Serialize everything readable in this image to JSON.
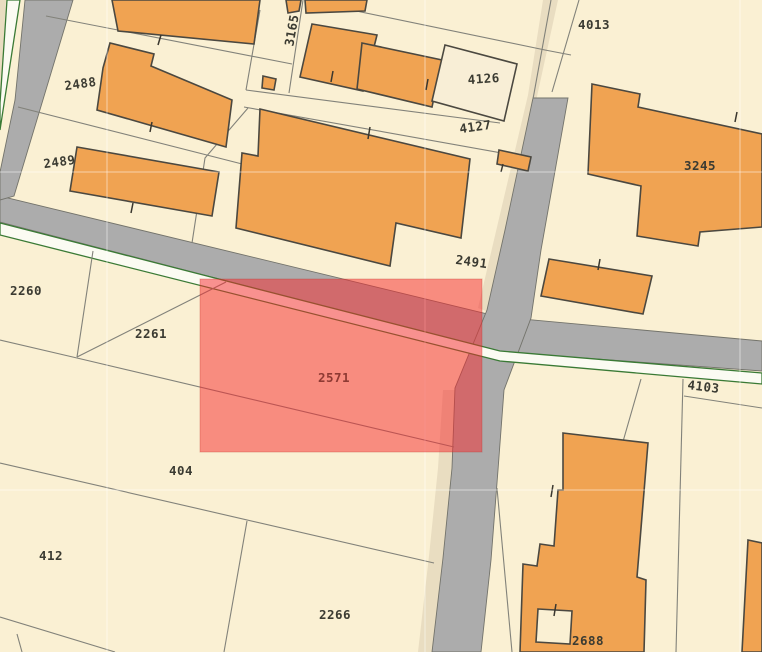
{
  "map": {
    "canvas": {
      "width": 762,
      "height": 652
    },
    "colors": {
      "parcel_base": "#FAF0D3",
      "parcel_dark": "#E9DDC1",
      "road": "#ACACAC",
      "road_edge": "#73736B",
      "stripe": "#FBFBF2",
      "stripe_green": "#3A7A35",
      "building": "#F0A352",
      "building_unfilled": "#F8EED6",
      "building_outline": "#4B4840",
      "parcel_line": "#82827A",
      "label": "#3B3B32",
      "tick": "#3A372F",
      "graticule": "rgba(255,255,255,0.5)",
      "selection_fill": "rgba(246,40,44,0.5)",
      "selection_stroke": "rgba(190,45,35,0.3)",
      "selection_label": "#8E3A33"
    },
    "accents": [
      {
        "name": "corner-verge-topleft",
        "points": [
          [
            0,
            0
          ],
          [
            6,
            0
          ],
          [
            0,
            100
          ]
        ]
      },
      {
        "name": "verge-band-topright",
        "points": [
          [
            543,
            0
          ],
          [
            558,
            0
          ],
          [
            508,
            230
          ],
          [
            489,
            312
          ],
          [
            478,
            308
          ],
          [
            528,
            95
          ]
        ]
      },
      {
        "name": "verge-band-bottom",
        "points": [
          [
            443,
            390
          ],
          [
            456,
            390
          ],
          [
            452,
            470
          ],
          [
            443,
            558
          ],
          [
            432,
            652
          ],
          [
            418,
            652
          ],
          [
            429,
            556
          ],
          [
            438,
            468
          ]
        ]
      }
    ],
    "roads": [
      {
        "name": "main-diagonal-road",
        "points": [
          [
            0,
            196
          ],
          [
            500,
            317
          ],
          [
            762,
            341
          ],
          [
            762,
            371
          ],
          [
            500,
            352
          ],
          [
            0,
            222
          ]
        ]
      },
      {
        "name": "left-edge-road",
        "points": [
          [
            25,
            0
          ],
          [
            73,
            0
          ],
          [
            14,
            196
          ],
          [
            0,
            200
          ],
          [
            0,
            172
          ],
          [
            15,
            100
          ]
        ]
      },
      {
        "name": "vertical-road",
        "points": [
          [
            533,
            98
          ],
          [
            568,
            98
          ],
          [
            541,
            250
          ],
          [
            531,
            318
          ],
          [
            504,
            390
          ],
          [
            498,
            470
          ],
          [
            491,
            560
          ],
          [
            481,
            652
          ],
          [
            432,
            652
          ],
          [
            443,
            558
          ],
          [
            452,
            468
          ],
          [
            455,
            388
          ],
          [
            487,
            310
          ],
          [
            505,
            230
          ]
        ]
      }
    ],
    "stripes": [
      {
        "name": "sidewalk-stripe-main",
        "points": [
          [
            0,
            223
          ],
          [
            500,
            351
          ],
          [
            762,
            373
          ],
          [
            762,
            384
          ],
          [
            500,
            361
          ],
          [
            0,
            235
          ]
        ]
      },
      {
        "name": "sidewalk-stripe-left",
        "points": [
          [
            7,
            0
          ],
          [
            20,
            0
          ],
          [
            0,
            130
          ],
          [
            0,
            103
          ]
        ]
      }
    ],
    "parcel_lines": [
      {
        "name": "a",
        "points": [
          [
            46,
            16
          ],
          [
            292,
            64
          ]
        ]
      },
      {
        "name": "b",
        "points": [
          [
            18,
            107
          ],
          [
            250,
            166
          ]
        ]
      },
      {
        "name": "c",
        "points": [
          [
            260,
            10
          ],
          [
            246,
            90
          ]
        ]
      },
      {
        "name": "d",
        "points": [
          [
            303,
            0
          ],
          [
            289,
            93
          ]
        ]
      },
      {
        "name": "e",
        "points": [
          [
            246,
            90
          ],
          [
            500,
            123
          ]
        ]
      },
      {
        "name": "f",
        "points": [
          [
            244,
            107
          ],
          [
            530,
            158
          ]
        ]
      },
      {
        "name": "g",
        "points": [
          [
            332,
            6
          ],
          [
            545,
            50
          ],
          [
            571,
            55
          ]
        ]
      },
      {
        "name": "g2",
        "points": [
          [
            248,
            108
          ],
          [
            205,
            158
          ],
          [
            192,
            243
          ]
        ]
      },
      {
        "name": "h",
        "points": [
          [
            551,
            0
          ],
          [
            533,
            99
          ]
        ]
      },
      {
        "name": "i",
        "points": [
          [
            579,
            0
          ],
          [
            552,
            92
          ]
        ]
      },
      {
        "name": "k",
        "points": [
          [
            93,
            251
          ],
          [
            77,
            357
          ]
        ]
      },
      {
        "name": "l",
        "points": [
          [
            0,
            340
          ],
          [
            77,
            358
          ],
          [
            454,
            447
          ]
        ]
      },
      {
        "name": "m",
        "points": [
          [
            226,
            282
          ],
          [
            77,
            357
          ]
        ]
      },
      {
        "name": "n",
        "points": [
          [
            0,
            463
          ],
          [
            434,
            563
          ]
        ]
      },
      {
        "name": "o1",
        "points": [
          [
            0,
            617
          ],
          [
            115,
            652
          ]
        ]
      },
      {
        "name": "o2",
        "points": [
          [
            17,
            634
          ],
          [
            22,
            652
          ]
        ]
      },
      {
        "name": "p",
        "points": [
          [
            247,
            521
          ],
          [
            224,
            652
          ]
        ]
      },
      {
        "name": "r",
        "points": [
          [
            683,
            379
          ],
          [
            676,
            652
          ]
        ]
      },
      {
        "name": "r0",
        "points": [
          [
            641,
            379
          ],
          [
            622,
            445
          ]
        ]
      },
      {
        "name": "r2",
        "points": [
          [
            684,
            396
          ],
          [
            762,
            408
          ]
        ]
      },
      {
        "name": "t",
        "points": [
          [
            497,
            488
          ],
          [
            512,
            652
          ]
        ]
      }
    ],
    "buildings": [
      {
        "name": "top-strip-a",
        "fill": "building",
        "points": [
          [
            112,
            0
          ],
          [
            260,
            0
          ],
          [
            254,
            44
          ],
          [
            118,
            31
          ]
        ]
      },
      {
        "name": "top-strip-b",
        "fill": "building",
        "points": [
          [
            286,
            0
          ],
          [
            301,
            0
          ],
          [
            299,
            11
          ],
          [
            288,
            13
          ]
        ]
      },
      {
        "name": "top-strip-c",
        "fill": "building",
        "points": [
          [
            305,
            0
          ],
          [
            367,
            0
          ],
          [
            365,
            11
          ],
          [
            306,
            13
          ]
        ]
      },
      {
        "name": "building-2488",
        "fill": "building",
        "points": [
          [
            103,
            68
          ],
          [
            110,
            43
          ],
          [
            154,
            54
          ],
          [
            151,
            66
          ],
          [
            232,
            100
          ],
          [
            226,
            147
          ],
          [
            97,
            110
          ]
        ]
      },
      {
        "name": "building-2489",
        "fill": "building",
        "points": [
          [
            77,
            147
          ],
          [
            219,
            172
          ],
          [
            212,
            216
          ],
          [
            70,
            191
          ]
        ]
      },
      {
        "name": "small-square",
        "fill": "building",
        "points": [
          [
            263,
            76
          ],
          [
            276,
            79
          ],
          [
            274,
            90
          ],
          [
            262,
            88
          ]
        ]
      },
      {
        "name": "pair-left",
        "fill": "building",
        "points": [
          [
            312,
            24
          ],
          [
            377,
            35
          ],
          [
            363,
            91
          ],
          [
            300,
            77
          ]
        ]
      },
      {
        "name": "pair-right",
        "fill": "building",
        "points": [
          [
            362,
            43
          ],
          [
            442,
            60
          ],
          [
            432,
            107
          ],
          [
            357,
            89
          ]
        ]
      },
      {
        "name": "building-4126",
        "fill": "building_unfilled",
        "points": [
          [
            445,
            45
          ],
          [
            517,
            64
          ],
          [
            504,
            121
          ],
          [
            432,
            101
          ]
        ]
      },
      {
        "name": "small-4127",
        "fill": "building",
        "points": [
          [
            499,
            150
          ],
          [
            531,
            157
          ],
          [
            528,
            171
          ],
          [
            497,
            164
          ]
        ]
      },
      {
        "name": "central-building",
        "fill": "building",
        "points": [
          [
            260,
            109
          ],
          [
            470,
            159
          ],
          [
            461,
            238
          ],
          [
            396,
            223
          ],
          [
            390,
            266
          ],
          [
            236,
            228
          ],
          [
            242,
            153
          ],
          [
            258,
            156
          ]
        ]
      },
      {
        "name": "building-3245",
        "fill": "building",
        "points": [
          [
            592,
            84
          ],
          [
            640,
            94
          ],
          [
            638,
            107
          ],
          [
            762,
            134
          ],
          [
            762,
            227
          ],
          [
            700,
            232
          ],
          [
            698,
            246
          ],
          [
            637,
            236
          ],
          [
            641,
            186
          ],
          [
            588,
            174
          ]
        ]
      },
      {
        "name": "building-2491-small",
        "fill": "building",
        "points": [
          [
            549,
            259
          ],
          [
            652,
            276
          ],
          [
            643,
            314
          ],
          [
            541,
            296
          ]
        ]
      },
      {
        "name": "building-2688",
        "fill": "building",
        "points": [
          [
            563,
            433
          ],
          [
            648,
            443
          ],
          [
            637,
            577
          ],
          [
            646,
            580
          ],
          [
            644,
            652
          ],
          [
            520,
            652
          ],
          [
            523,
            564
          ],
          [
            537,
            566
          ],
          [
            540,
            544
          ],
          [
            554,
            546
          ],
          [
            558,
            490
          ],
          [
            563,
            490
          ]
        ],
        "hole": [
          [
            538,
            609
          ],
          [
            572,
            611
          ],
          [
            570,
            644
          ],
          [
            536,
            642
          ]
        ]
      },
      {
        "name": "right-edge-bottom",
        "fill": "building",
        "points": [
          [
            748,
            540
          ],
          [
            762,
            543
          ],
          [
            762,
            652
          ],
          [
            742,
            652
          ]
        ]
      }
    ],
    "ticks": [
      {
        "points": [
          [
            161,
            35
          ],
          [
            158,
            45
          ]
        ]
      },
      {
        "points": [
          [
            133,
            203
          ],
          [
            131,
            213
          ]
        ]
      },
      {
        "points": [
          [
            152,
            122
          ],
          [
            150,
            132
          ]
        ]
      },
      {
        "points": [
          [
            370,
            127
          ],
          [
            368,
            139
          ]
        ]
      },
      {
        "points": [
          [
            428,
            79
          ],
          [
            426,
            90
          ]
        ]
      },
      {
        "points": [
          [
            333,
            71
          ],
          [
            331,
            82
          ]
        ]
      },
      {
        "points": [
          [
            600,
            259
          ],
          [
            598,
            270
          ]
        ]
      },
      {
        "points": [
          [
            737,
            112
          ],
          [
            735,
            122
          ]
        ]
      },
      {
        "points": [
          [
            553,
            485
          ],
          [
            551,
            497
          ]
        ]
      },
      {
        "points": [
          [
            556,
            604
          ],
          [
            554,
            616
          ]
        ]
      },
      {
        "points": [
          [
            503,
            164
          ],
          [
            501,
            172
          ]
        ]
      }
    ],
    "graticule": {
      "vertical": [
        107,
        425,
        740
      ],
      "horizontal": [
        172,
        490
      ]
    },
    "selection": {
      "parcel": "2571",
      "x": 200,
      "y": 279,
      "width": 282,
      "height": 173
    },
    "labels": [
      {
        "text": "2488",
        "x": 81,
        "y": 88,
        "rot": -8
      },
      {
        "text": "2489",
        "x": 60,
        "y": 166,
        "rot": -8
      },
      {
        "text": "3165",
        "x": 296,
        "y": 31,
        "rot": -80
      },
      {
        "text": "4013",
        "x": 594,
        "y": 29,
        "rot": 0
      },
      {
        "text": "4126",
        "x": 484,
        "y": 83,
        "rot": -4
      },
      {
        "text": "4127",
        "x": 476,
        "y": 131,
        "rot": -8
      },
      {
        "text": "3245",
        "x": 700,
        "y": 170,
        "rot": 0
      },
      {
        "text": "2491",
        "x": 471,
        "y": 266,
        "rot": 8
      },
      {
        "text": "2260",
        "x": 26,
        "y": 295,
        "rot": 0
      },
      {
        "text": "2261",
        "x": 151,
        "y": 338,
        "rot": 0
      },
      {
        "text": "2571",
        "x": 334,
        "y": 382,
        "rot": 0,
        "color": "selection_label"
      },
      {
        "text": "404",
        "x": 181,
        "y": 475,
        "rot": 0
      },
      {
        "text": "412",
        "x": 51,
        "y": 560,
        "rot": 0
      },
      {
        "text": "2266",
        "x": 335,
        "y": 619,
        "rot": 0
      },
      {
        "text": "4103",
        "x": 703,
        "y": 391,
        "rot": 7
      },
      {
        "text": "2688",
        "x": 588,
        "y": 645,
        "rot": 0
      }
    ]
  }
}
